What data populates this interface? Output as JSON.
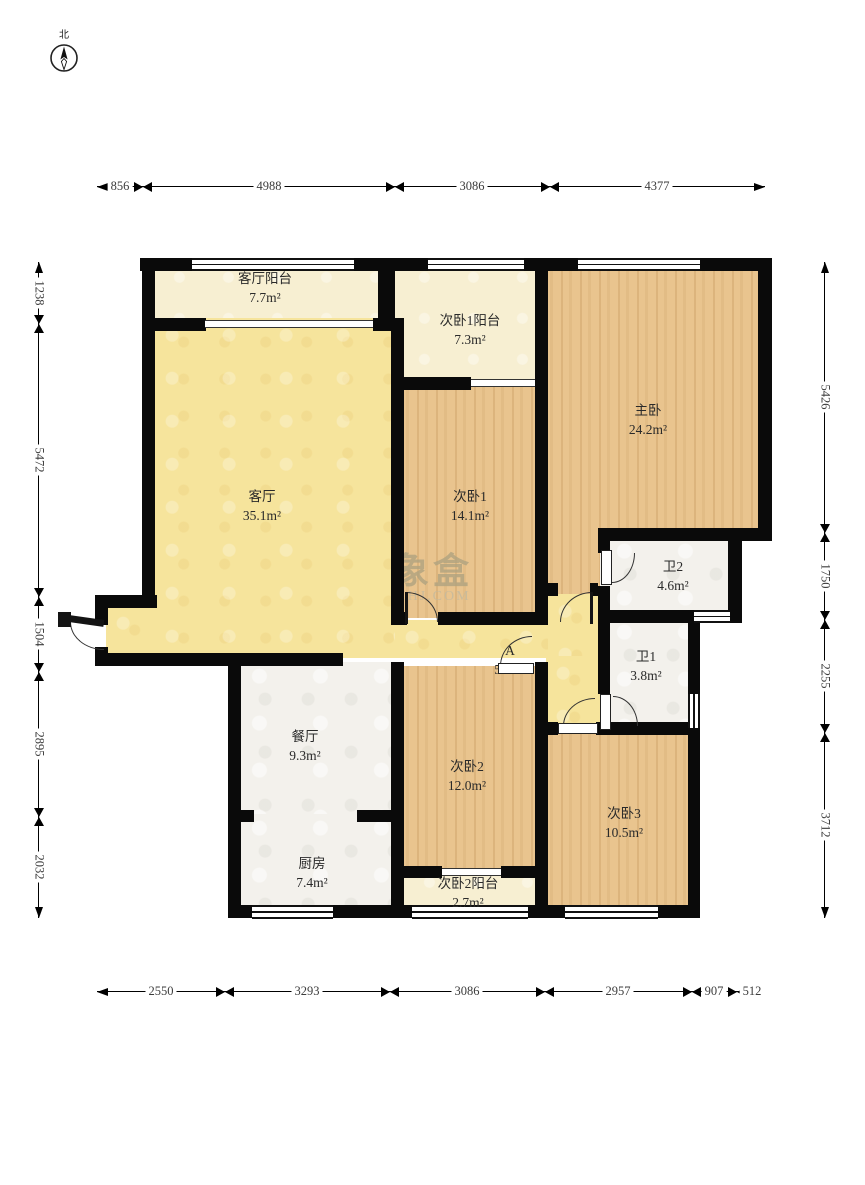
{
  "compass": {
    "north_label": "北"
  },
  "watermark": {
    "brand": "象盒",
    "site": "XHJ.COM"
  },
  "rooms": [
    {
      "id": "living-balcony",
      "name": "客厅阳台",
      "area": "7.7m²"
    },
    {
      "id": "bed1-balcony",
      "name": "次卧1阳台",
      "area": "7.3m²"
    },
    {
      "id": "master-bedroom",
      "name": "主卧",
      "area": "24.2m²"
    },
    {
      "id": "living-room",
      "name": "客厅",
      "area": "35.1m²"
    },
    {
      "id": "bedroom-1",
      "name": "次卧1",
      "area": "14.1m²"
    },
    {
      "id": "bathroom-2",
      "name": "卫2",
      "area": "4.6m²"
    },
    {
      "id": "hallway-a",
      "name": "A",
      "area": "5.9m²"
    },
    {
      "id": "bathroom-1",
      "name": "卫1",
      "area": "3.8m²"
    },
    {
      "id": "dining-room",
      "name": "餐厅",
      "area": "9.3m²"
    },
    {
      "id": "bedroom-2",
      "name": "次卧2",
      "area": "12.0m²"
    },
    {
      "id": "bedroom-3",
      "name": "次卧3",
      "area": "10.5m²"
    },
    {
      "id": "kitchen",
      "name": "厨房",
      "area": "7.4m²"
    },
    {
      "id": "bed2-balcony",
      "name": "次卧2阳台",
      "area": "2.7m²"
    }
  ],
  "dimensions": {
    "top": [
      "856",
      "4988",
      "3086",
      "4377"
    ],
    "bottom": [
      "2550",
      "3293",
      "3086",
      "2957",
      "907",
      "512"
    ],
    "left": [
      "1238",
      "5472",
      "1504",
      "2895",
      "2032"
    ],
    "right": [
      "5426",
      "1750",
      "2255",
      "3712"
    ]
  },
  "colors": {
    "wall": "#0a0a0a",
    "living_yellow": "#f6e49c",
    "balcony_cream": "#f7efd2",
    "bedroom_wood": "#e9c48e",
    "tile_white": "#f3f1ec"
  }
}
